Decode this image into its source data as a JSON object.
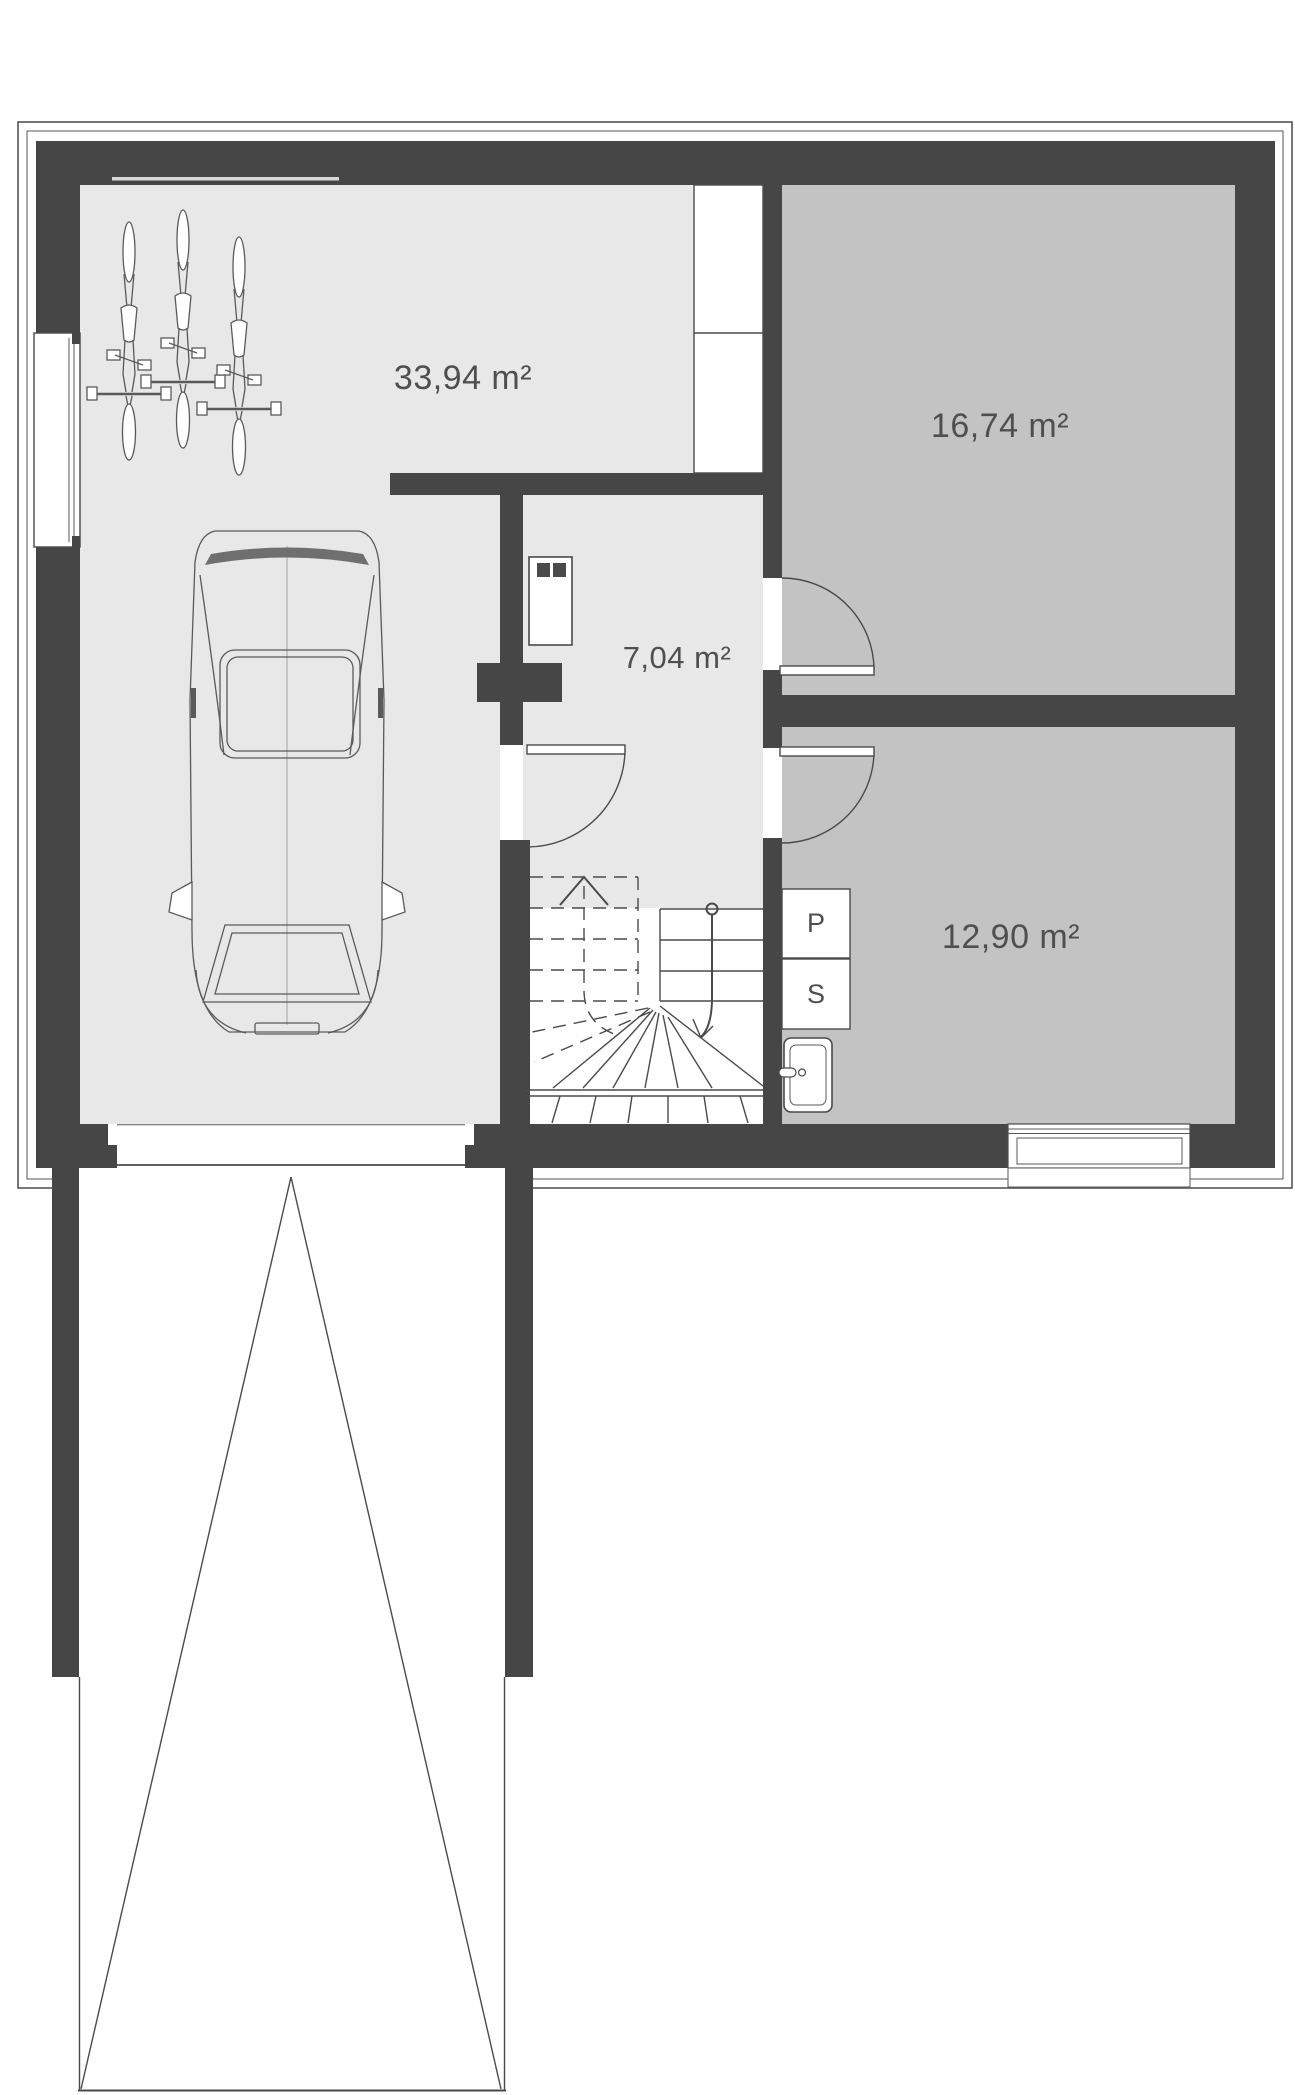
{
  "plan": {
    "type": "basement-floor-plan",
    "colors": {
      "wall": "#464646",
      "floor_light": "#e8e8e8",
      "floor_medium": "#c3c3c3",
      "line": "#4a4a4a",
      "text": "#4f4f4f",
      "background": "#ffffff",
      "white": "#ffffff"
    },
    "rooms": [
      {
        "name": "garage",
        "area_label": "33,94 m²"
      },
      {
        "name": "room-top-right",
        "area_label": "16,74 m²"
      },
      {
        "name": "corridor",
        "area_label": "7,04 m²"
      },
      {
        "name": "room-bottom-right",
        "area_label": "12,90 m²"
      }
    ],
    "appliances": [
      {
        "label": "P"
      },
      {
        "label": "S"
      }
    ]
  }
}
